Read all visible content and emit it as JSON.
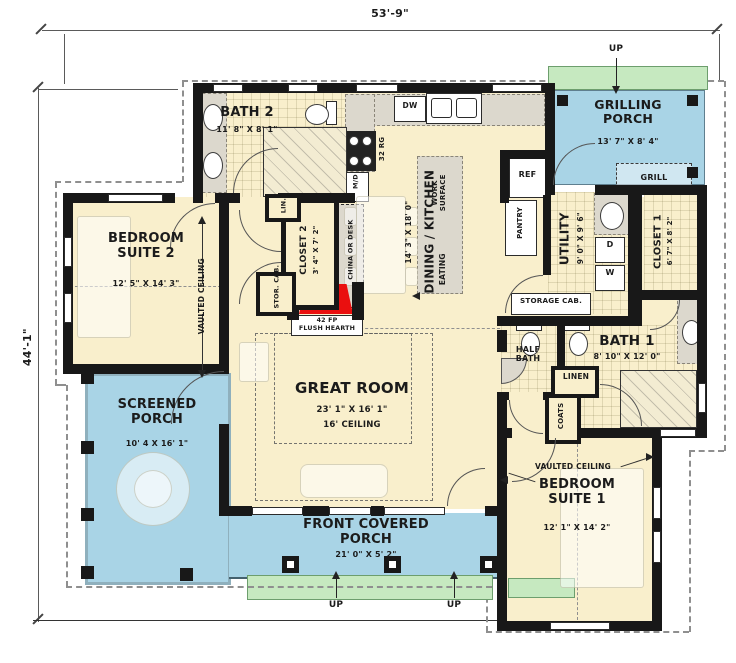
{
  "colors": {
    "floor": "#f9efcc",
    "porch": "#a9d4e6",
    "green": "#c6e9c0",
    "counter": "#dcd8cd",
    "wall": "#181818",
    "hearth": "#ea0f0f",
    "dashline": "#8f8f8f"
  },
  "dims": {
    "top": "53'-9\"",
    "left": "44'-1\""
  },
  "rooms": {
    "bath2": {
      "name": "BATH 2",
      "dims": "11' 8\" X 8' 1\""
    },
    "grilling": {
      "name": "GRILLING PORCH",
      "dims": "13' 7\" X 8' 4\""
    },
    "bedroom2": {
      "name": "BEDROOM SUITE 2",
      "dims": "12' 5\" X 14' 3\""
    },
    "kitchen": {
      "name": "DINING / KITCHEN",
      "dims": "14' 3\" X 18' 0\""
    },
    "closet2": {
      "name": "CLOSET 2",
      "dims": "3' 4\" X 7' 2\""
    },
    "utility": {
      "name": "UTILITY",
      "dims": "9' 0\" X 9' 6\""
    },
    "closet1": {
      "name": "CLOSET 1",
      "dims": "6' 7\" X 8' 2\""
    },
    "bath1": {
      "name": "BATH 1",
      "dims": "8' 10\" X 12' 0\""
    },
    "halfbath": {
      "name": "HALF BATH"
    },
    "great": {
      "name": "GREAT ROOM",
      "dims": "23' 1\" X 16' 1\"",
      "ceiling": "16' CEILING"
    },
    "screened": {
      "name": "SCREENED PORCH",
      "dims": "10' 4 X 16' 1\""
    },
    "front": {
      "name": "FRONT COVERED PORCH",
      "dims": "21' 0\" X 5' 2\""
    },
    "bedroom1": {
      "name": "BEDROOM SUITE 1",
      "dims": "12' 1\" X 14' 2\""
    }
  },
  "fixtures": {
    "grill": "GRILL",
    "ref": "REF",
    "pantry": "PANTRY",
    "dw": "DW",
    "range": "32 RG",
    "md": "M/D",
    "lin": "LIN.",
    "linen": "LINEN",
    "coats": "COATS",
    "china": "CHINA OR DESK",
    "storcab": "STOR. CAB.",
    "storagecab": "STORAGE CAB.",
    "work": "WORK SURFACE",
    "eating": "EATING",
    "hearth1": "42 FP",
    "hearth2": "FLUSH HEARTH",
    "washer": "W",
    "dryer": "D"
  },
  "notes": {
    "up": "UP",
    "vaulted": "VAULTED CEILING"
  }
}
